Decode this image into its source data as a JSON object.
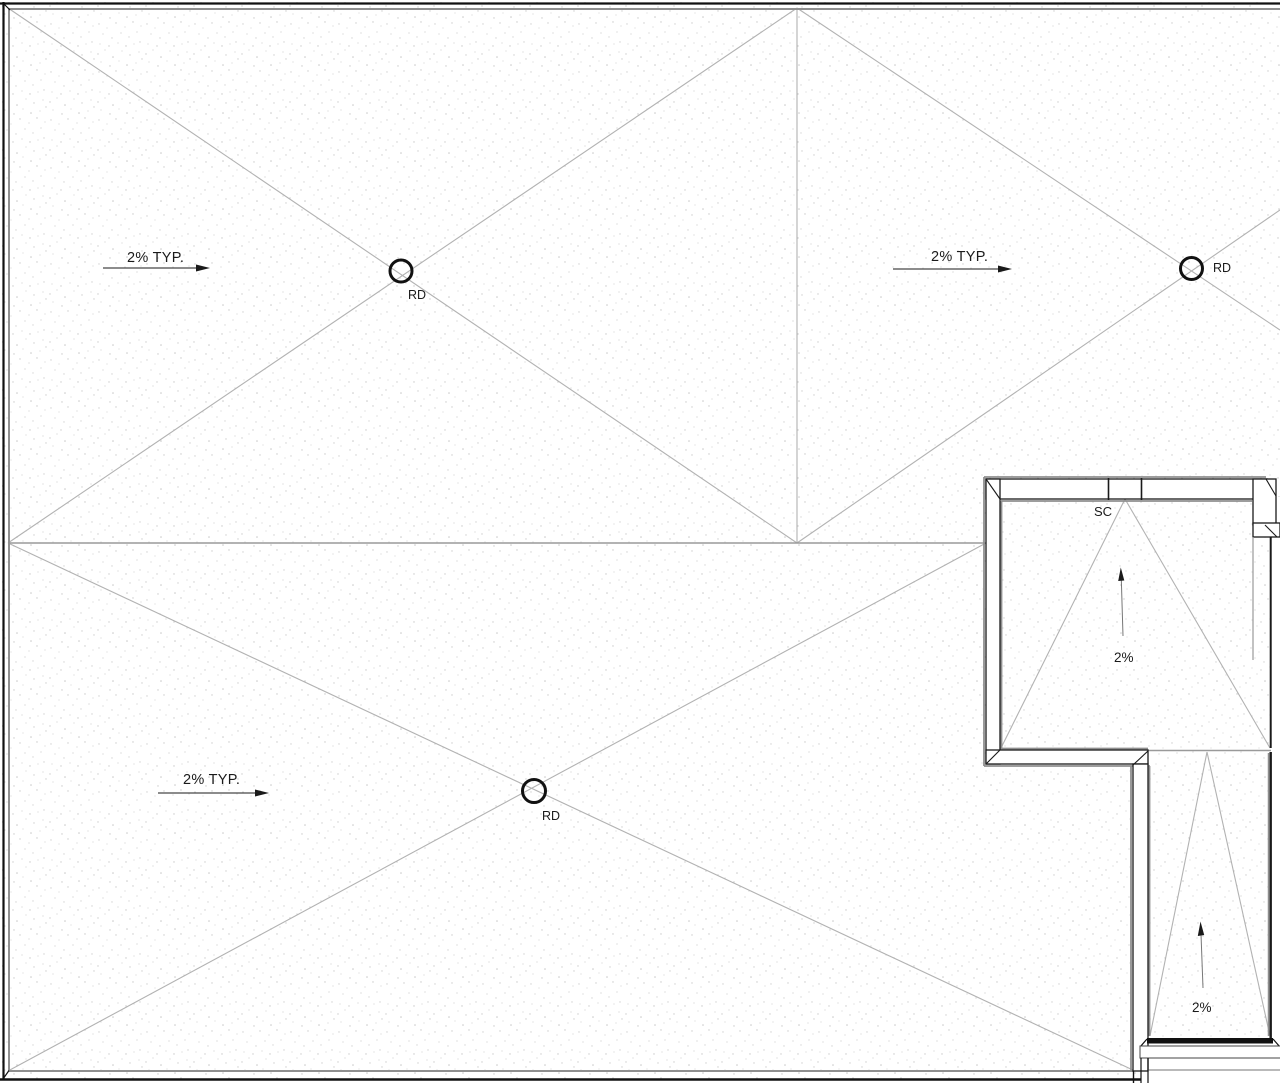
{
  "colors": {
    "paper": "#ffffff",
    "stipple": "#cccccc",
    "roof_line": "#b2b2b2",
    "ridge_line": "#9a9a9a",
    "wall_line": "#1a1a1a",
    "shadow_line": "#8f8f8f",
    "text": "#1a1a1a"
  },
  "labels": {
    "slope_typ_upper_left": "2% TYP.",
    "slope_typ_upper_right": "2% TYP.",
    "slope_typ_lower": "2% TYP.",
    "drain_upper_left": "RD",
    "drain_upper_right": "RD",
    "drain_lower": "RD",
    "scupper": "SC",
    "slope_enclosure": "2%",
    "slope_strip": "2%"
  }
}
